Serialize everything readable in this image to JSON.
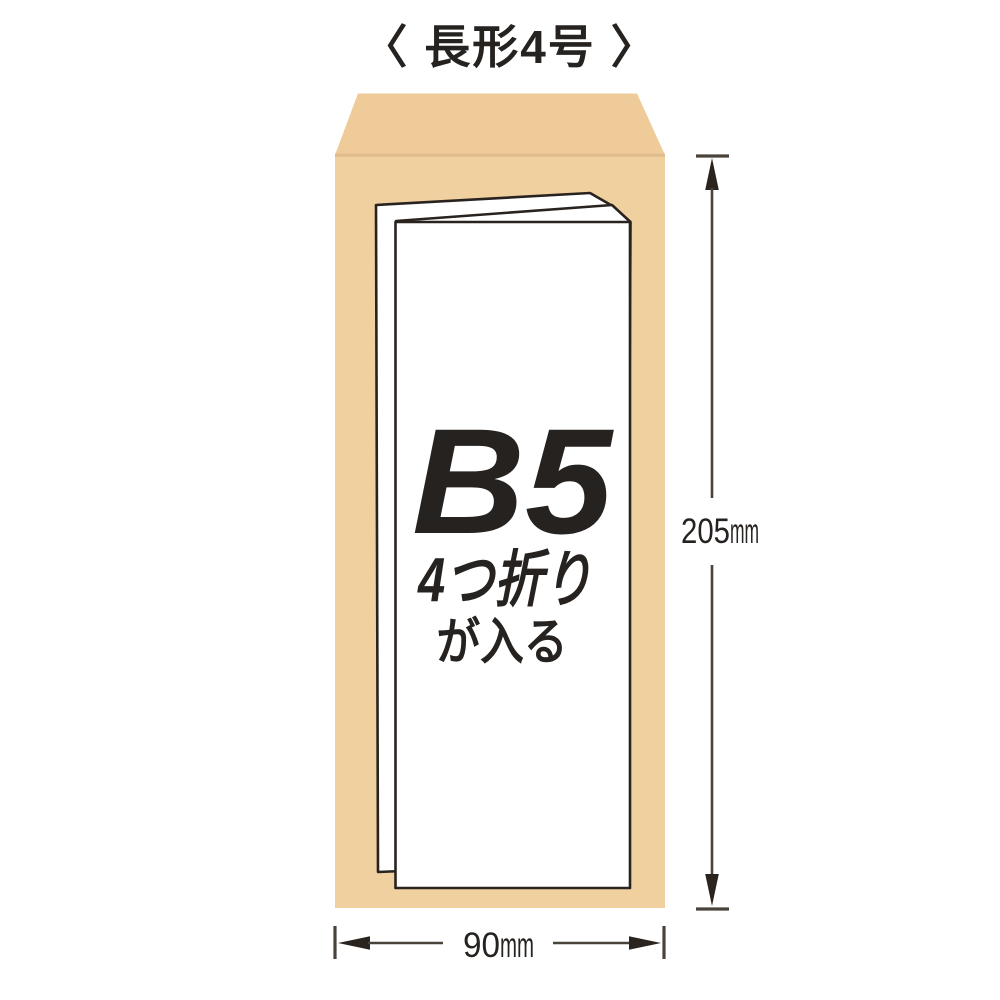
{
  "title": "〈 長形4号 〉",
  "envelope": {
    "name": "長形4号",
    "type": "kraft-envelope",
    "height_label": {
      "value": "205",
      "unit": "mm"
    },
    "width_label": {
      "value": "90",
      "unit": "mm"
    }
  },
  "paper": {
    "size": "B5",
    "fold": "4つ折り",
    "note": "が入る"
  },
  "colors": {
    "envelope_flap": "#eecb98",
    "envelope_body": "#f1d0a0",
    "fold_crease": "#e1bd8d",
    "paper_fill": "#ffffff",
    "outline_ink": "#29231f",
    "dimension_line": "#4a433c",
    "text_ink": "#262220"
  }
}
